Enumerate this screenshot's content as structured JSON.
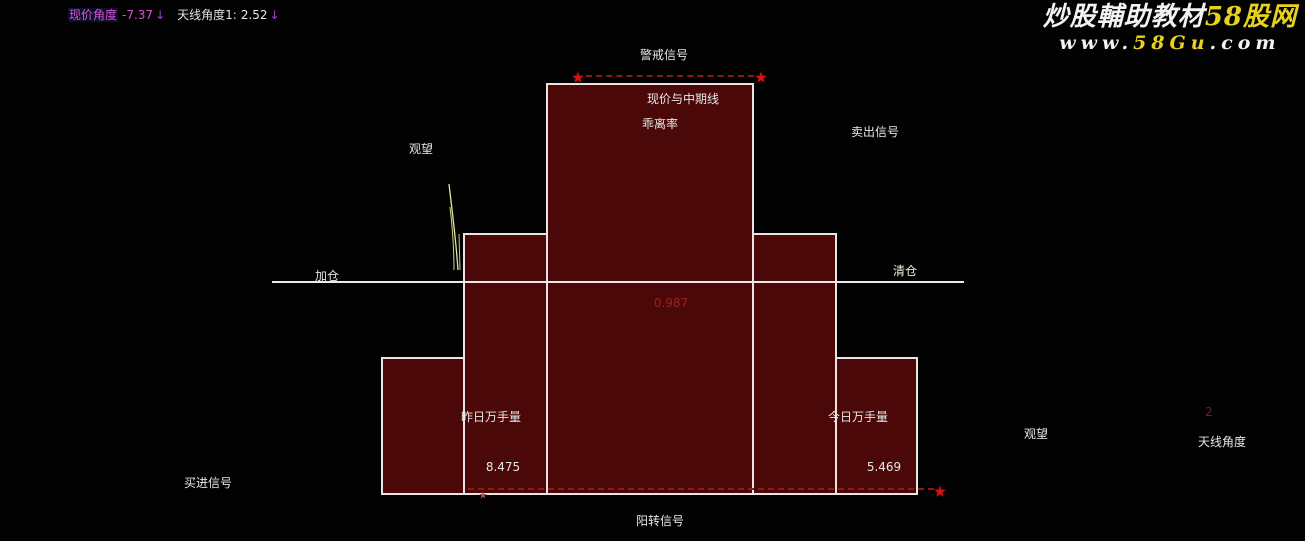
{
  "header": {
    "price_angle_label": "现价角度",
    "price_angle_value": "-7.37",
    "price_angle_arrow": "↓",
    "antenna_angle_label": "天线角度1:",
    "antenna_angle_value": "2.52",
    "antenna_angle_arrow": "↓"
  },
  "watermark": {
    "brand_white": "炒股輔助教材",
    "brand_yellow": "58股网",
    "url_prefix": "www.",
    "url_highlight": "58Gu",
    "url_suffix": ".com"
  },
  "labels": {
    "warning_signal": "警戒信号",
    "box_title_line1": "现价与中期线",
    "box_title_line2": "乖离率",
    "watch_left": "观望",
    "sell_signal": "卖出信号",
    "add_position": "加仓",
    "clear_position": "清仓",
    "bias_value": "0.987",
    "yesterday_volume_label": "昨日万手量",
    "yesterday_volume_value": "8.475",
    "today_volume_label": "今日万手量",
    "today_volume_value": "5.469",
    "buy_signal": "买进信号",
    "yang_turn_signal": "阳转信号",
    "watch_right": "观望",
    "antenna_angle_label": "天线角度",
    "antenna_angle_value": "2"
  },
  "icons": {
    "star": "★"
  },
  "colors": {
    "background": "#020202",
    "box_fill": "#4a0808",
    "box_border": "#ece2e2",
    "zero_line_white": "#eceaea",
    "star_red": "#d41414",
    "dashed_red": "#8a1a1a",
    "magenta": "#d455d4",
    "arrow_purple": "#9a44cc",
    "brand_yellow": "#e8d21c",
    "bias_value_red": "#9c2020",
    "spike_yellow": "#e6e69a",
    "text_white": "#e8e8e8"
  },
  "chart_data": {
    "type": "bar",
    "title": "现价与中期线 乖离率",
    "indicators": [
      {
        "name": "现价角度",
        "value": -7.37,
        "direction": "down"
      },
      {
        "name": "天线角度1",
        "value": 2.52,
        "direction": "down"
      },
      {
        "name": "乖离率",
        "value": 0.987
      },
      {
        "name": "昨日万手量",
        "value": 8.475
      },
      {
        "name": "今日万手量",
        "value": 5.469
      },
      {
        "name": "天线角度",
        "value": 2
      }
    ],
    "signals": [
      "警戒信号",
      "观望",
      "卖出信号",
      "加仓",
      "清仓",
      "买进信号",
      "阳转信号",
      "观望"
    ],
    "structure": "symmetric 5-column step pyramid of dark-maroon boxes with white borders; center column tallest; white zero line crosses all columns near mid-height",
    "annotations": [
      "red stars at the two top corners of the center column joined by a dark-red dashed line",
      "red star at lower right of the pyramid with dark-red dashed line running left along the base",
      "thin yellow spike curve just left of the mid-left column"
    ],
    "legend_position": "none",
    "grid": false
  }
}
